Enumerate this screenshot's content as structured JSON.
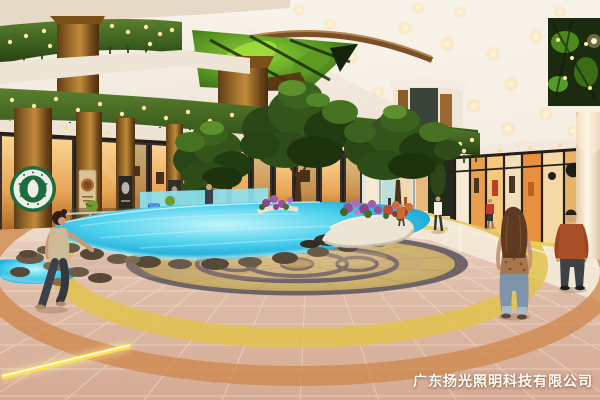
{
  "meta": {
    "title": "Shopping mall atrium interior — lighting design rendering"
  },
  "watermark": {
    "text": "广东扬光照明科技有限公司",
    "color": "#ffffff"
  },
  "scene": {
    "labels": {
      "ceiling": "cream ceiling with recessed warm downlights",
      "skylight": "skylight bay with giant green leaf graphic and dark steel structure",
      "garlands": "balcony fascias covered in hanging plants with warm string lights",
      "upper_columns": "copper-brown cylindrical columns on upper gallery",
      "lower_columns": "copper-brown columns along left storefronts",
      "coffee_logo": "round green coffee-shop logo on foreground column",
      "column_posters": "poster banners on columns",
      "storefronts_left": "amber back-lit retail storefronts",
      "storefronts_right": "glass storefronts with warm display lighting",
      "corridor": "distant mall corridor",
      "trees": "indoor landscape trees",
      "pool": "LED-lit blue water feature with scattered rocks",
      "cafe": "cafe terrace with railing, tables and topiaries",
      "bench": "white curved planter bench with purple and red flowers",
      "medallion": "golden oval mosaic floor medallion with dark rings",
      "floor_rings": "yellow and orange tile arcs around medallion",
      "led_strip": "glowing yellow floor light strip",
      "guide_strips": "yellow guide strips on glossy floor",
      "people": [
        "woman walking, beige top, dark trousers (left foreground)",
        "woman with long brown hair, jeans (right foreground, back view)",
        "man in rust-brown jacket (right foreground)",
        "distant man in white shirt",
        "distant woman in red",
        "distant shopper in orange"
      ]
    },
    "colors": {
      "ceiling": "#f3ece2",
      "greenery": "#3f6322",
      "string_lights": "#ffe9a0",
      "pool_water": "#3fc9e8",
      "pool_glow": "#aef2fc",
      "floor_tile": "#ddbca9",
      "ring_yellow": "#e2c24e",
      "ring_orange": "#d08a50",
      "column_copper": "#9a6b26",
      "medallion_gold": "#c9ad6a",
      "storefront_glow": "#f2a649",
      "logo_green": "#1e6b3f"
    }
  }
}
